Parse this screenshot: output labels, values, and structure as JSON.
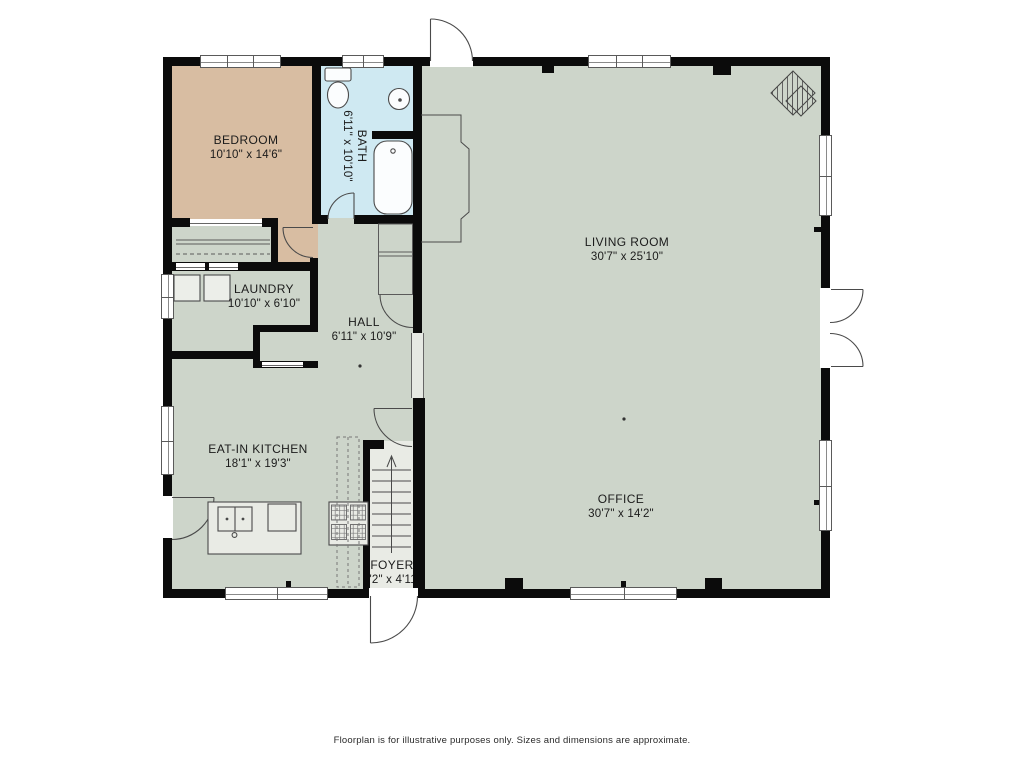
{
  "rooms": {
    "bedroom": {
      "label": "BEDROOM",
      "dims": "10'10\" x 14'6\""
    },
    "bath": {
      "label": "BATH",
      "dims": "6'11\" x 10'10\""
    },
    "laundry": {
      "label": "LAUNDRY",
      "dims": "10'10\" x 6'10\""
    },
    "hall": {
      "label": "HALL",
      "dims": "6'11\" x 10'9\""
    },
    "living_room": {
      "label": "LIVING ROOM",
      "dims": "30'7\" x 25'10\""
    },
    "kitchen": {
      "label": "EAT-IN KITCHEN",
      "dims": "18'1\" x 19'3\""
    },
    "office": {
      "label": "OFFICE",
      "dims": "30'7\" x 14'2\""
    },
    "foyer": {
      "label": "FOYER",
      "dims": "8'2\" x 4'11\""
    }
  },
  "footer": {
    "disclaimer": "Floorplan is for illustrative purposes only. Sizes and dimensions are approximate."
  },
  "colors": {
    "wall": "#0b0b0b",
    "floor_main": "#cdd5ca",
    "floor_bedroom": "#d8bda2",
    "floor_bath": "#cfe9f2",
    "floor_light": "#e9ebe5",
    "line": "#4a4a4a",
    "text": "#1b1b1b"
  }
}
